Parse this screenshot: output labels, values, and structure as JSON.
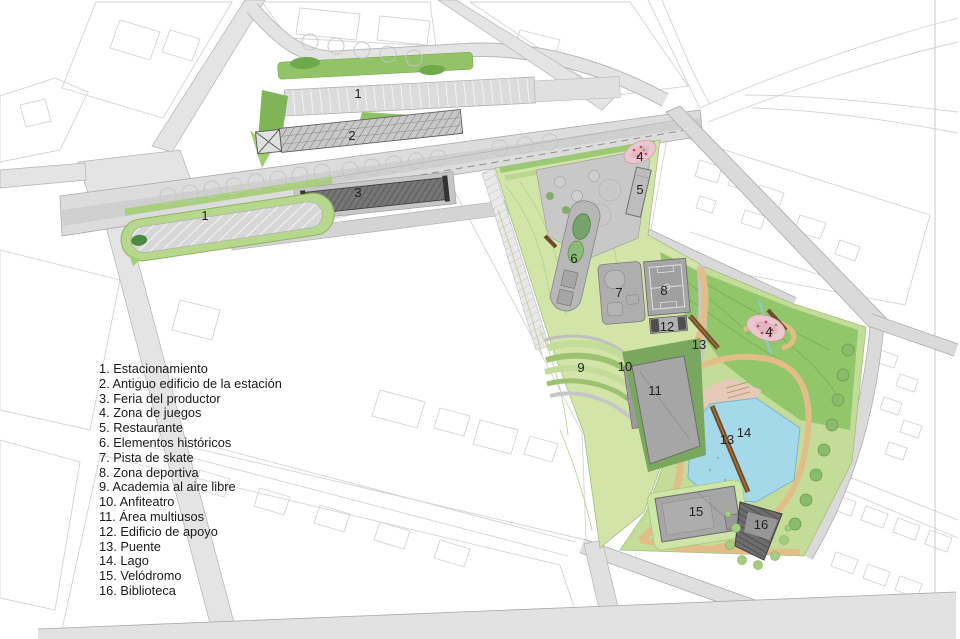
{
  "map": {
    "type": "landscape-master-plan",
    "labels": [
      {
        "n": "1",
        "x": 358,
        "y": 94,
        "feature": "Estacionamiento"
      },
      {
        "n": "2",
        "x": 352,
        "y": 136,
        "feature": "Antiguo edificio de la estación"
      },
      {
        "n": "3",
        "x": 358,
        "y": 193,
        "feature": "Feria del productor"
      },
      {
        "n": "1",
        "x": 205,
        "y": 216,
        "feature": "Estacionamiento"
      },
      {
        "n": "4",
        "x": 640,
        "y": 157,
        "feature": "Zona de juegos"
      },
      {
        "n": "5",
        "x": 640,
        "y": 190,
        "feature": "Restaurante"
      },
      {
        "n": "6",
        "x": 574,
        "y": 259,
        "feature": "Elementos históricos"
      },
      {
        "n": "7",
        "x": 619,
        "y": 293,
        "feature": "Pista de skate"
      },
      {
        "n": "8",
        "x": 664,
        "y": 291,
        "feature": "Zona deportiva"
      },
      {
        "n": "12",
        "x": 667,
        "y": 327,
        "feature": "Edificio de apoyo"
      },
      {
        "n": "13",
        "x": 699,
        "y": 345,
        "feature": "Puente"
      },
      {
        "n": "9",
        "x": 581,
        "y": 368,
        "feature": "Academia al aire libre"
      },
      {
        "n": "10",
        "x": 625,
        "y": 367,
        "feature": "Anfiteatro"
      },
      {
        "n": "11",
        "x": 655,
        "y": 391,
        "feature": "Área multiusos"
      },
      {
        "n": "4",
        "x": 769,
        "y": 332,
        "feature": "Zona de juegos"
      },
      {
        "n": "13",
        "x": 727,
        "y": 440,
        "feature": "Puente"
      },
      {
        "n": "14",
        "x": 744,
        "y": 433,
        "feature": "Lago"
      },
      {
        "n": "15",
        "x": 696,
        "y": 512,
        "feature": "Velódromo"
      },
      {
        "n": "16",
        "x": 761,
        "y": 525,
        "feature": "Biblioteca"
      }
    ]
  },
  "legend": {
    "items": [
      "1. Estacionamiento",
      "2. Antiguo edificio de la estación",
      "3. Feria del productor",
      "4. Zona de juegos",
      "5. Restaurante",
      "6. Elementos históricos",
      "7. Pista de skate",
      "8. Zona deportiva",
      "9. Academia al aire libre",
      "10. Anfiteatro",
      "11. Área multiusos",
      "12. Edificio de apoyo",
      "13. Puente",
      "14. Lago",
      "15. Velódromo",
      "16. Biblioteca"
    ]
  },
  "colors": {
    "background": "#ffffff",
    "context_line": "#d3d3d3",
    "road_fill": "#e2e2e2",
    "rail_fill": "#dcdcdc",
    "park_base": "#d2e4a8",
    "park_south": "#c3dd99",
    "lawn": "#8fc468",
    "dark_green": "#79a75e",
    "lake_blue": "#a5d8e8",
    "path_tan": "#e2bd87",
    "sand_pink": "#e8c8ba",
    "playground_pink": "#eac7d0",
    "building_gray": "#a6a6a6",
    "building_dark": "#6f6f6f",
    "bridge_brown": "#6e4a26",
    "label_color": "#1f1f1f"
  }
}
